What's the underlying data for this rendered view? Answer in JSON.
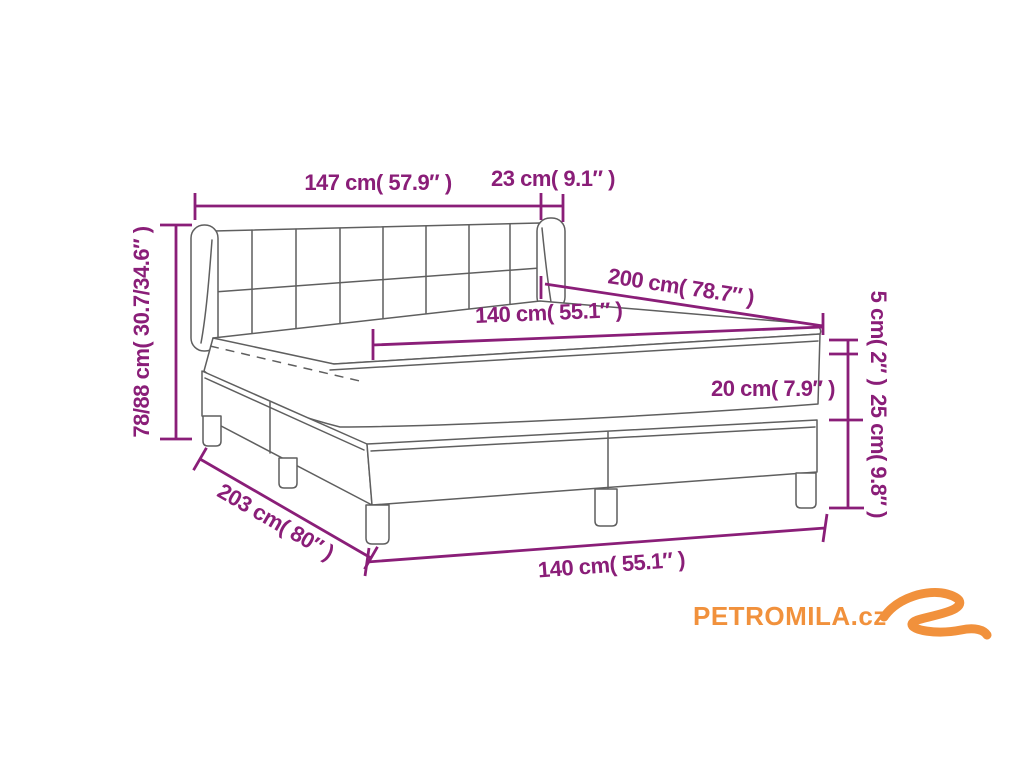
{
  "diagram": {
    "type": "product-dimension-diagram",
    "product": "box-spring-bed",
    "labels": {
      "headboard_width": "147 cm( 57.9″ )",
      "wing_depth": "23 cm( 9.1″ )",
      "bed_height": "78/88 cm( 30.7/34.6″ )",
      "bed_length": "200 cm( 78.7″ )",
      "mattress_width": "140 cm( 55.1″ )",
      "topper_height": "5 cm( 2″ )",
      "mattress_height": "20 cm( 7.9″ )",
      "base_height": "25 cm( 9.8″ )",
      "frame_length": "203 cm( 80″ )",
      "frame_width": "140 cm( 55.1″ )"
    },
    "colors": {
      "dimension_lines": "#8A1E78",
      "drawing_lines": "#5f5f5f",
      "logo": "#F1913C",
      "background": "#ffffff"
    },
    "logo": {
      "text": "PETROMILA.cz"
    }
  }
}
